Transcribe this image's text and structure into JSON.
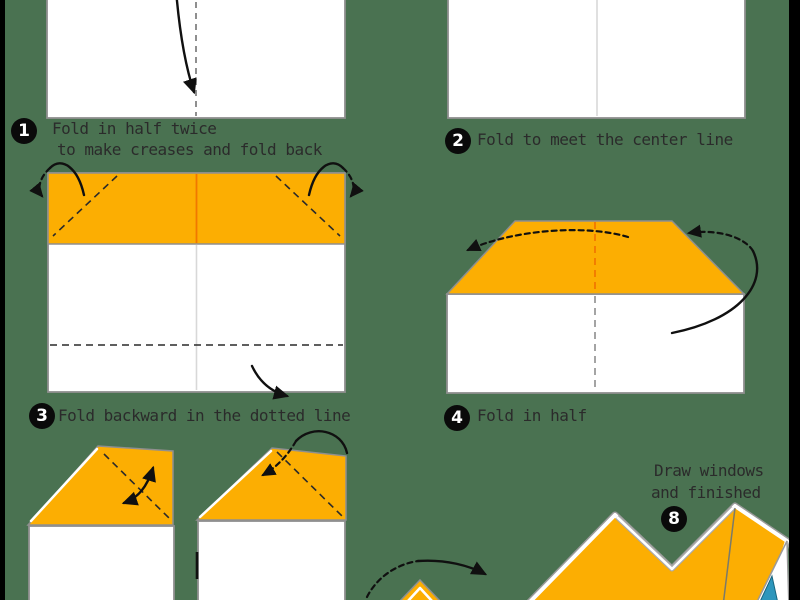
{
  "colors": {
    "page_green": "#4A7251",
    "bar_black": "#000000",
    "paper_orange": "#FCAE02",
    "crease_orange": "#F07800",
    "border_gray": "#8F8F8F",
    "text_dark": "#2B2B2B",
    "teal_accent": "#2D96BC"
  },
  "steps": {
    "s1": {
      "number": "1",
      "line1": "Fold in half twice",
      "line2": "to make creases and fold back"
    },
    "s2": {
      "number": "2",
      "label": "Fold to meet the center line"
    },
    "s3": {
      "number": "3",
      "label": "Fold backward in the dotted line"
    },
    "s4": {
      "number": "4",
      "label": "Fold in half"
    },
    "s8": {
      "number": "8",
      "line1": "Draw windows",
      "line2": "and finished"
    }
  }
}
